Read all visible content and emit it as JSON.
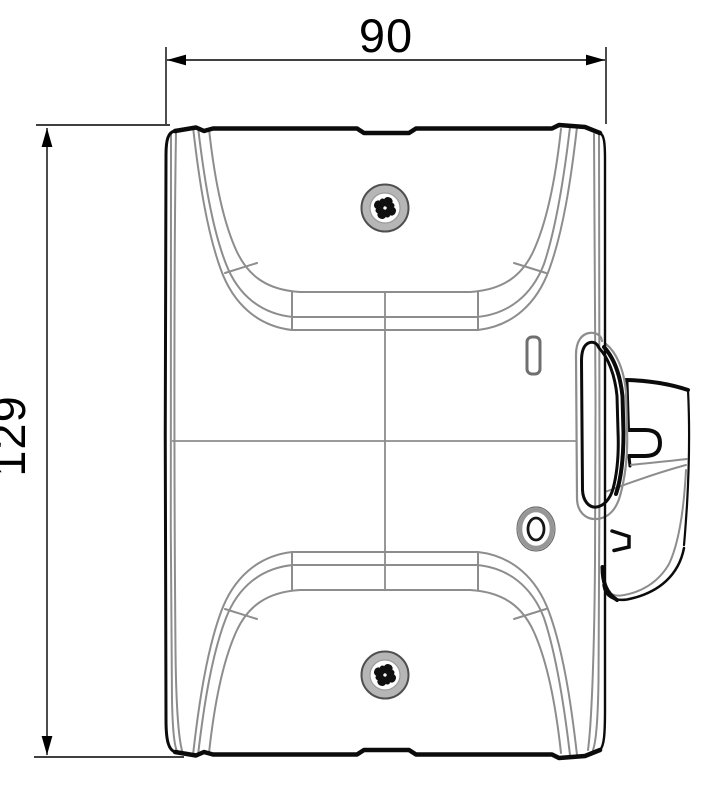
{
  "drawing": {
    "background": "#ffffff",
    "type": "technical-orthographic-view",
    "dimensions": {
      "width": {
        "label": "90",
        "value": 90
      },
      "height": {
        "label": "129",
        "value": 129
      }
    },
    "features": {
      "top_screw": "phillips-screw",
      "bottom_screw": "phillips-screw",
      "slot": "vertical-slot",
      "grommet": "oval-grommet",
      "latch": "side-latch-lever",
      "clip": "belt-clip-bracket"
    },
    "colors": {
      "outline": "#0b0b0b",
      "contour": "#8d8d8d",
      "dimension_line": "#000000",
      "screw_ring_fill": "#b6b6b6",
      "screw_rim": "#4f4f4f",
      "slot_stroke": "#6f6f6f",
      "grommet_ring": "#969696"
    }
  }
}
